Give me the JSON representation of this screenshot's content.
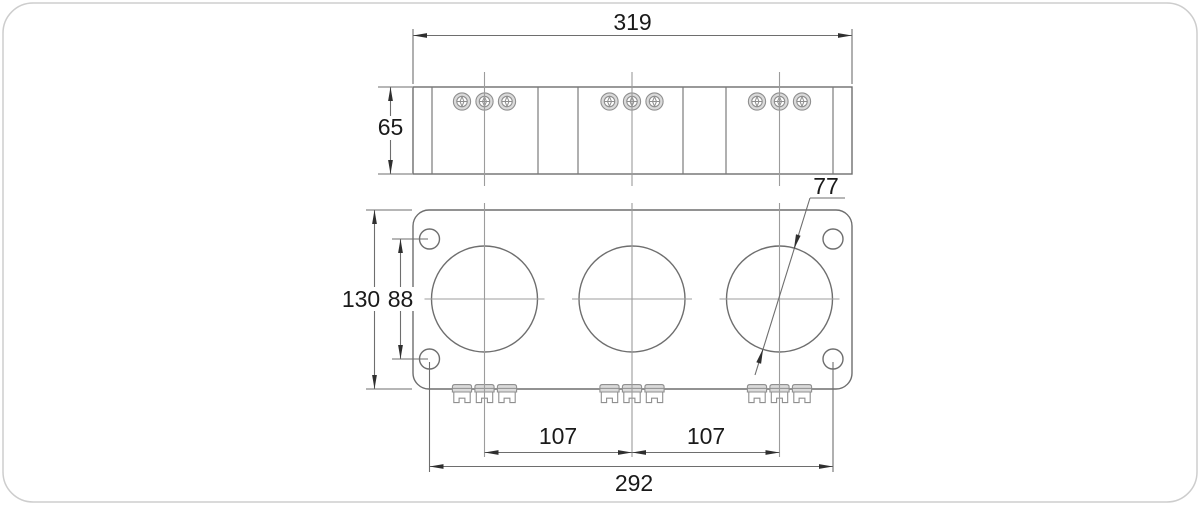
{
  "drawing": {
    "kind": "technical-dimension-drawing",
    "dimensions": {
      "overall_width": "319",
      "body_height": "65",
      "plate_height": "130",
      "mount_hole_vertical_pitch": "88",
      "window_diameter": "77",
      "window_pitch_left": "107",
      "window_pitch_right": "107",
      "mount_hole_horizontal_pitch": "292"
    },
    "colors": {
      "background": "#ffffff",
      "frame_border": "#cdcdcd",
      "outline": "#6e6e6e",
      "centerline": "#9c9c9c",
      "shading": "#dadada",
      "arrowhead": "#2f2f2f",
      "text": "#1a1a1a"
    }
  }
}
